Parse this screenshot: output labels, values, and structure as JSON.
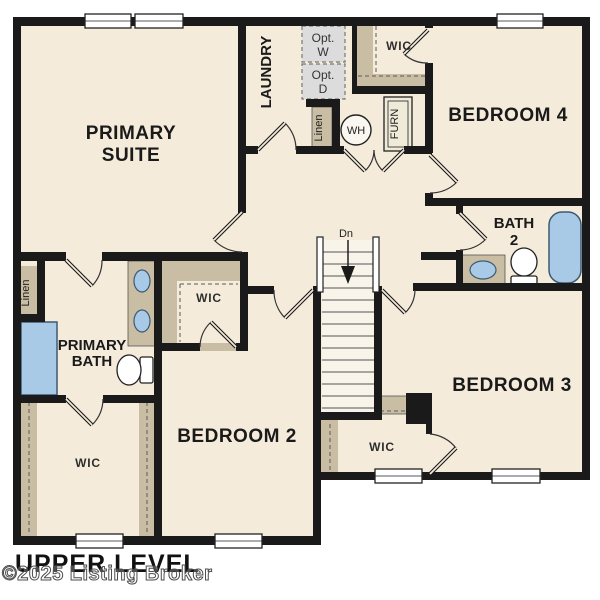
{
  "plan_title": "UPPER LEVEL",
  "watermark": "©2025 Listing Broker",
  "colors": {
    "floor": "#f4ebdb",
    "wall": "#1a1a1a",
    "closet_tan": "#c9bda4",
    "fixture_blue": "#a9cae6",
    "fixture_blue_border": "#3d5a73",
    "optional_appliance_gray": "#dcdcdc"
  },
  "rooms": {
    "primary_suite": {
      "line1": "PRIMARY",
      "line2": "SUITE"
    },
    "laundry": {
      "label": "LAUNDRY"
    },
    "opt_washer": {
      "line1": "Opt.",
      "line2": "W"
    },
    "opt_dryer": {
      "line1": "Opt.",
      "line2": "D"
    },
    "wic_top": {
      "label": "WIC"
    },
    "bedroom4": {
      "label": "BEDROOM 4"
    },
    "linen_laundry": {
      "label": "Linen"
    },
    "water_heater": {
      "label": "WH"
    },
    "furnace": {
      "label": "FURN"
    },
    "bath2": {
      "line1": "BATH",
      "line2": "2"
    },
    "linen_hall": {
      "label": "Linen"
    },
    "primary_bath": {
      "line1": "PRIMARY",
      "line2": "BATH"
    },
    "wic_mid": {
      "label": "WIC"
    },
    "stairs": {
      "down_label": "Dn"
    },
    "bedroom2": {
      "label": "BEDROOM 2"
    },
    "bedroom3": {
      "label": "BEDROOM 3"
    },
    "wic_bottom_left": {
      "label": "WIC"
    },
    "wic_bottom_right": {
      "label": "WIC"
    }
  }
}
